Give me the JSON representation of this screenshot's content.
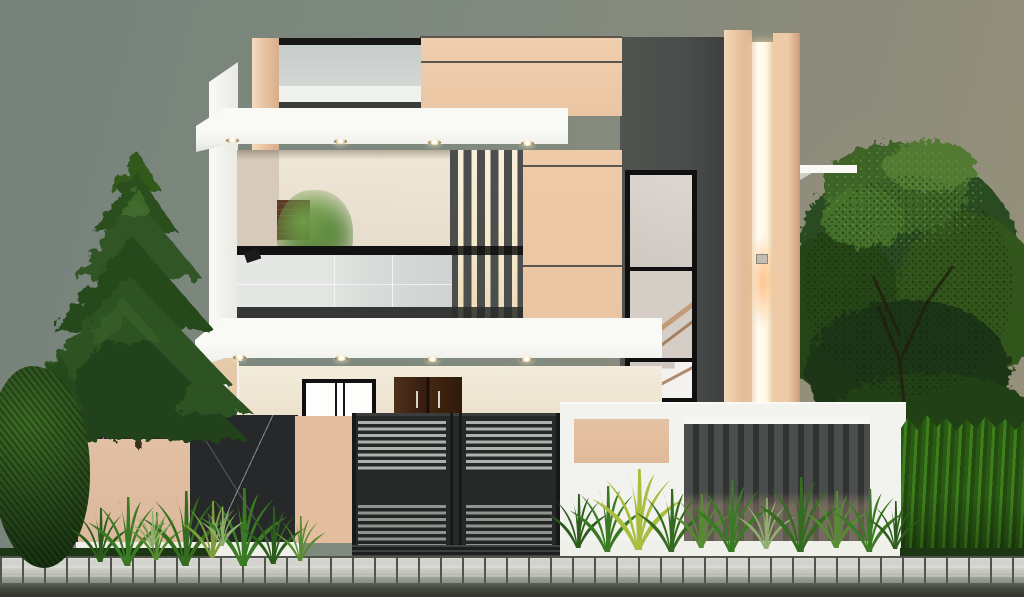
{
  "scene": {
    "type": "3d-architectural-render",
    "subject": "modern two-storey duplex house front elevation at dusk",
    "text_content": "none",
    "objects": [
      "sky-backdrop",
      "pine-tree",
      "deciduous-tree",
      "hedge",
      "shrub",
      "house-facade",
      "terrace-glass-railing",
      "terrace-parapet",
      "canopy-slab-upper",
      "balcony",
      "balcony-glass-railing",
      "louver-screen",
      "charcoal-feature-wall",
      "stairwell-window",
      "front-pillars",
      "pillar-light-strip",
      "wall-ledge",
      "canopy-slab-lower",
      "ground-floor-window",
      "entrance-door",
      "porch-slabs",
      "marble-compound-wall",
      "entrance-gate",
      "right-compound-wall",
      "fence-louvers",
      "garden-plants",
      "stone-kerb",
      "road"
    ]
  },
  "palette": {
    "sky-1": "#76827a",
    "sky-2": "#7e897e",
    "sky-3": "#8a8b7c",
    "sky-4": "#97917a",
    "white-bright": "#f9f9f6",
    "white": "#f2f2ee",
    "white-dim": "#e2e2db",
    "white-shadow": "#cfcfc8",
    "beige-light": "#f6dcc0",
    "beige": "#eac5a3",
    "beige-dark": "#d8ae8a",
    "beige-deep": "#c79a74",
    "beige-gf": "#e9ddc8",
    "beige-panel": "#dcb79b",
    "charcoal": "#4a4d4b",
    "charcoal-dark": "#3e4140",
    "near-black": "#161616",
    "frame-black": "#101010",
    "glass-terrace": "#c6ccc9",
    "glass-balcony": "#d9dcd9",
    "glass-stair": "#d8d2cc",
    "louver-bg": "#f5e9cc",
    "louver-slat": "#4b4e4d",
    "wood-dark": "#3c2315",
    "wood-mid": "#5c3a26",
    "gate-body": "#272928",
    "gate-slat-light": "#aeb1ac",
    "gate-slat-dim": "#90938e",
    "gate-frame": "#171918",
    "marble": "#26282a",
    "marble-vein": "#d7dce0",
    "base-white": "#f0f0eb",
    "fence-slat": "#4a4d4c",
    "fence-gap": "#303332",
    "stone-light": "#d2d3cd",
    "stone-mid": "#9a9d94",
    "stone-joint": "#51544b",
    "road": "#3f443c",
    "pine-1": "#24431a",
    "pine-2": "#2e5323",
    "pine-3": "#27481c",
    "pine-4": "#305426",
    "pine-5": "#2b4f1e",
    "pine-6": "#33581f",
    "pine-hi": "#4f7d33",
    "tree-1": "#2c4b20",
    "tree-2": "#264419",
    "tree-3": "#30541f",
    "tree-4": "#3c6326",
    "tree-hi": "#527a33",
    "tree-dark": "#1c3414",
    "branch": "#241b10",
    "hedge-1": "#3f7e1d",
    "hedge-2": "#2a5a14",
    "hedge-3": "#234b10",
    "p1": "#2c5c1c",
    "p2": "#3b7a24",
    "p3": "#568c31",
    "p4": "#7d9c3a",
    "p5": "#a9bd3e",
    "p6": "#346b20",
    "p7": "#8fae6f",
    "bush-1": "#3c6b24",
    "bush-2": "#26471a",
    "bush-3": "#16300f",
    "lit-core": "#fffdf4",
    "lit-warm": "#f3d9ae",
    "flare": "#ff9e4d",
    "interior-wall": "#efe7d8",
    "interior-dark": "#ded2bf",
    "pot-white": "#fcfcfa"
  }
}
